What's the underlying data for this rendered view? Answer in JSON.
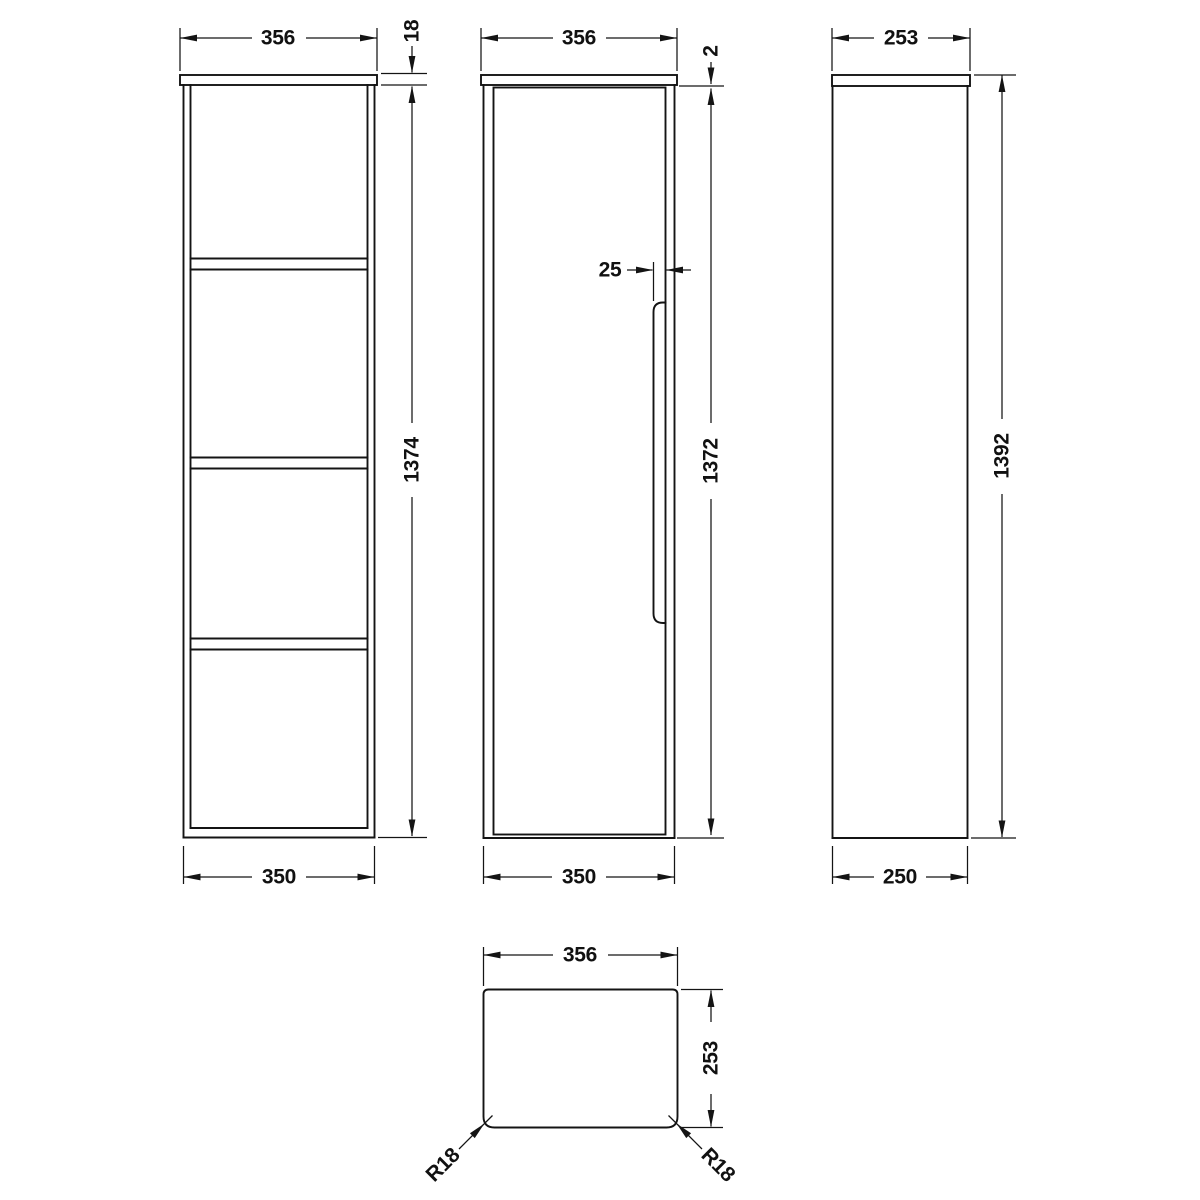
{
  "drawing": {
    "type": "technical-dimension-drawing",
    "subject": "tall wall-hung cabinet, four orthographic views",
    "colors": {
      "line": "#141414",
      "background": "#ffffff"
    },
    "views": {
      "front_open": {
        "name": "front elevation - open shelves",
        "dim_top_width": "356",
        "dim_board_thickness": "18",
        "dim_height": "1374",
        "dim_bottom_width": "350",
        "shelf_count": 3,
        "compartment_count": 4
      },
      "front_door": {
        "name": "front elevation - door",
        "dim_top_width": "356",
        "dim_top_gap": "2",
        "dim_handle_recess": "25",
        "dim_door_height": "1372",
        "dim_bottom_width": "350"
      },
      "side": {
        "name": "side elevation",
        "dim_top_depth": "253",
        "dim_overall_height": "1392",
        "dim_bottom_depth": "250"
      },
      "plan": {
        "name": "plan view",
        "dim_width": "356",
        "dim_depth": "253",
        "dim_radius_left": "R18",
        "dim_radius_right": "R18"
      }
    }
  }
}
